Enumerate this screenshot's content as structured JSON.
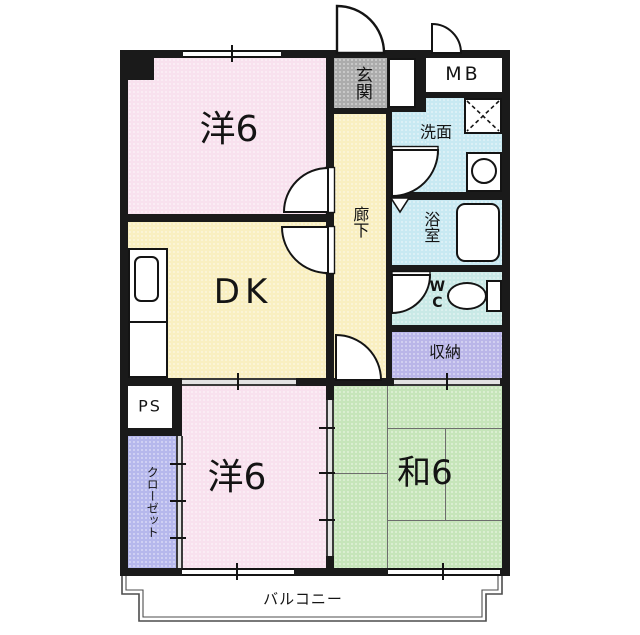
{
  "plan": {
    "type": "japanese-apartment-floor-plan",
    "rooms": {
      "western_top": {
        "label": "洋6"
      },
      "dining_kitchen": {
        "label": "DK"
      },
      "western_bottom": {
        "label": "洋6"
      },
      "japanese_room": {
        "label": "和6"
      },
      "entrance": {
        "label": "玄関"
      },
      "meter_box": {
        "label": "MB"
      },
      "washroom": {
        "label": "洗面"
      },
      "bathroom": {
        "label": "浴室"
      },
      "corridor": {
        "label": "廊下"
      },
      "toilet": {
        "label": "WC"
      },
      "storage": {
        "label": "収納"
      },
      "pipe_space": {
        "label": "PS"
      },
      "closet": {
        "label": "クローゼット"
      },
      "balcony": {
        "label": "バルコニー"
      }
    },
    "colors": {
      "wall": "#1a1a1a",
      "western_room": "#f8e1ee",
      "yellow_area": "#f9efc1",
      "wet_area_blue": "#c8e9f2",
      "toilet_cyan": "#c9e9e6",
      "storage_lavender": "#bab6e8",
      "closet_lavender": "#b6b8ec",
      "japanese_green": "#c6e5ba",
      "entrance_gray": "#acacac",
      "fixture_white": "#ffffff"
    }
  }
}
